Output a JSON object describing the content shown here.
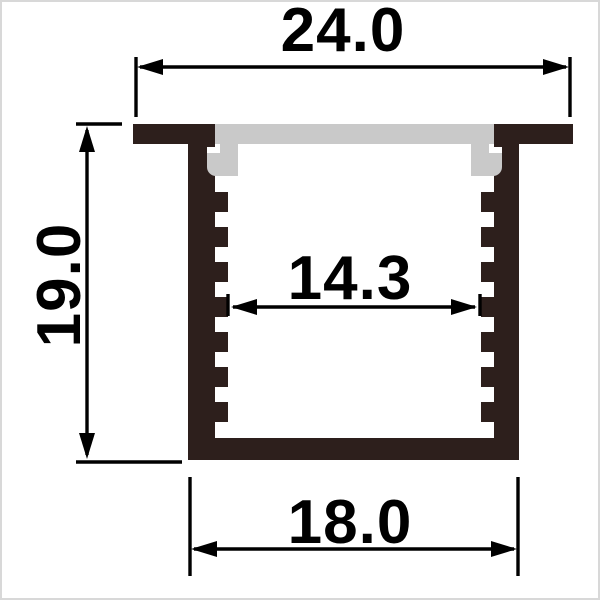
{
  "drawing": {
    "labels": {
      "top_width": "24.0",
      "overall_height": "19.0",
      "inner_width": "14.3",
      "bottom_width": "18.0"
    },
    "colors": {
      "profile": "#2d1f1c",
      "diffuser": "#c9c9c9",
      "notch": "#ffffff",
      "dimension": "#000000",
      "background": "#ffffff"
    }
  }
}
